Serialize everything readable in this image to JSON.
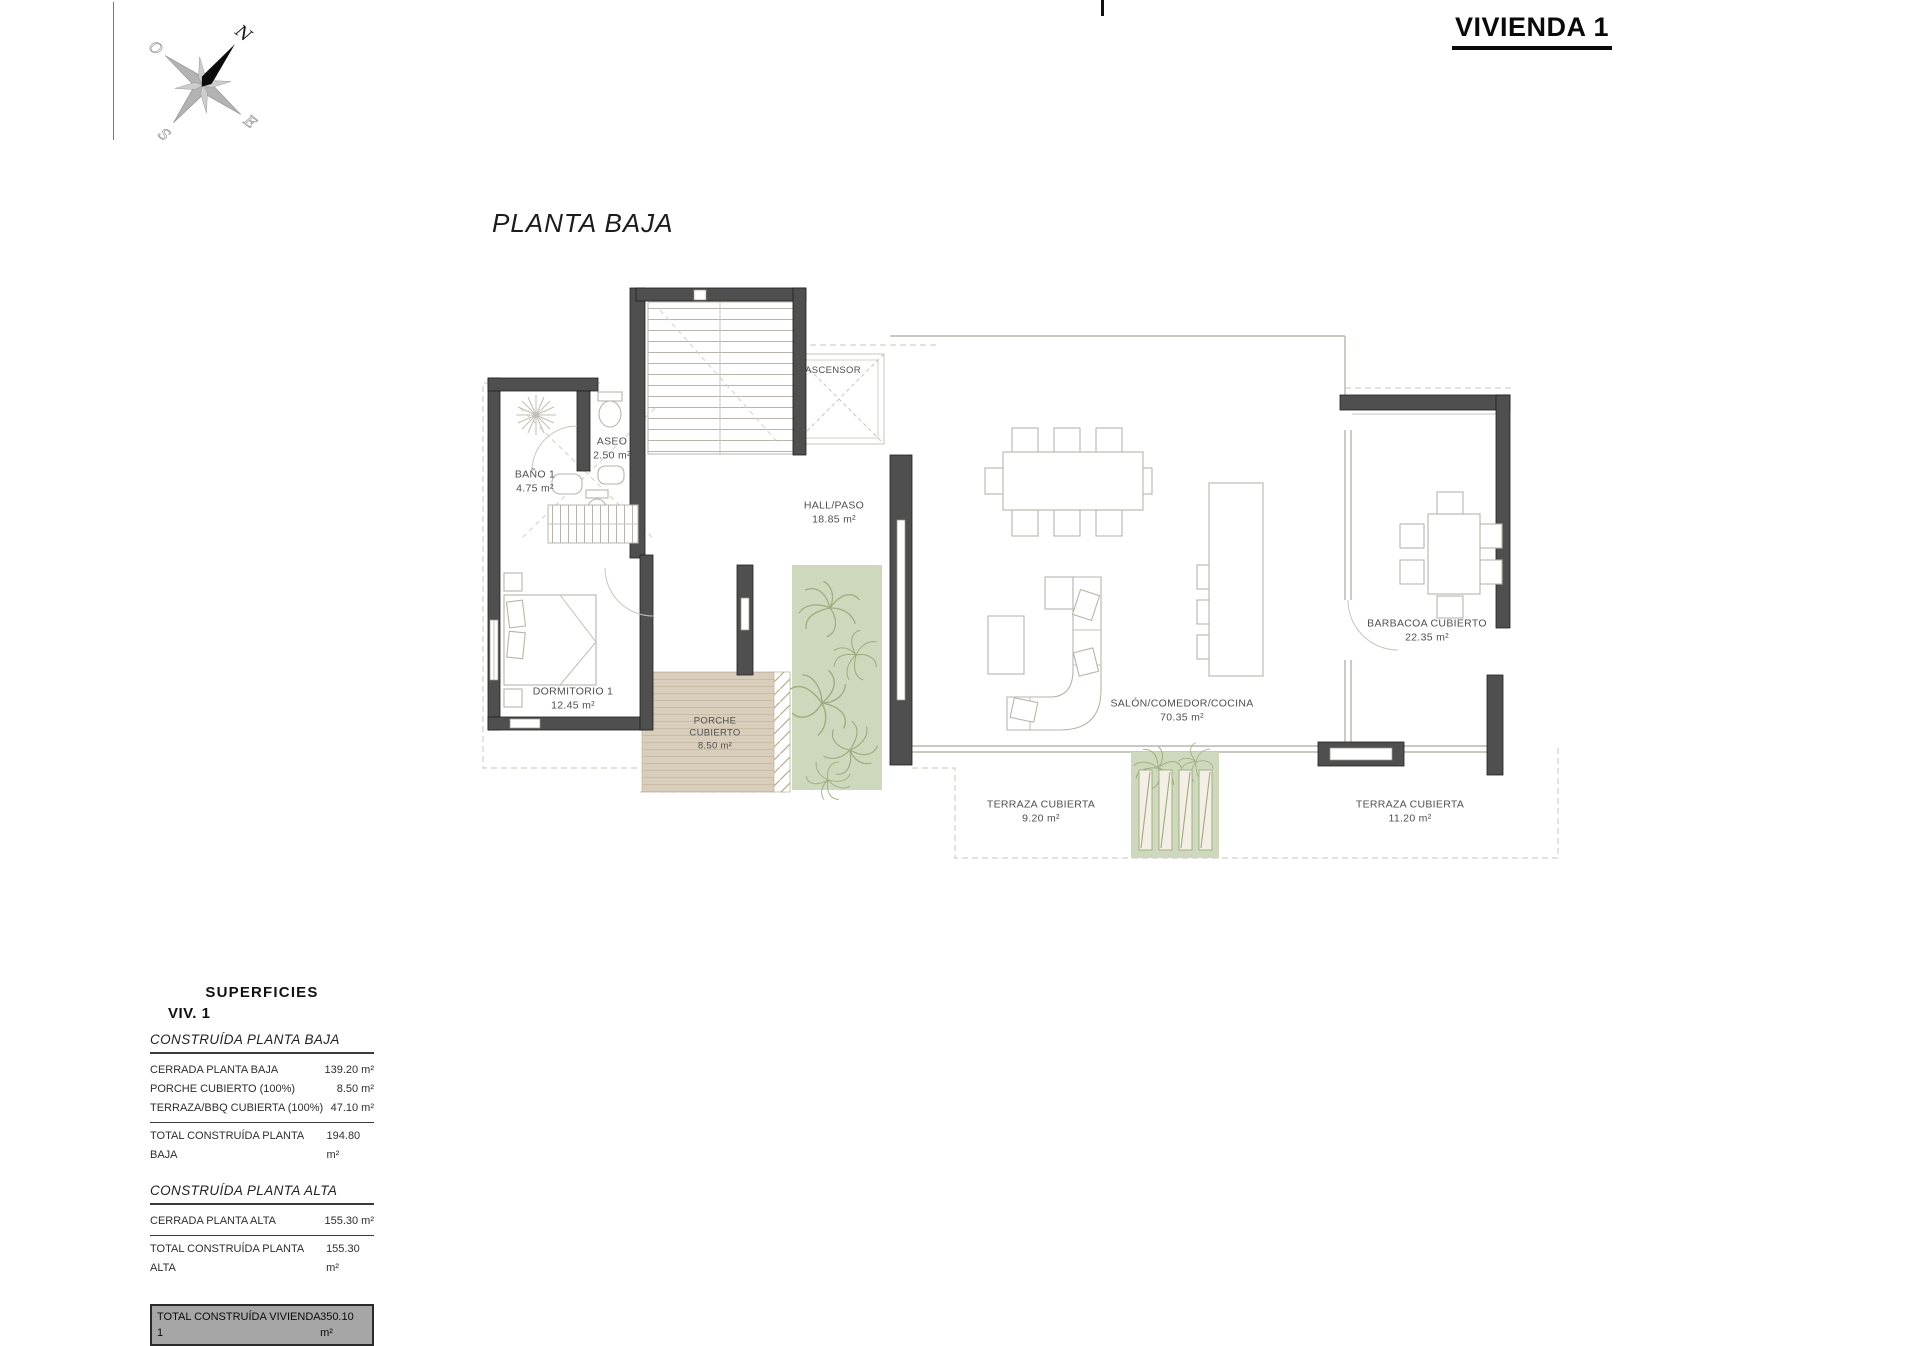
{
  "header": {
    "title": "VIVIENDA 1"
  },
  "plan": {
    "title": "PLANTA BAJA"
  },
  "compass": {
    "n": "N",
    "e": "E",
    "s": "S",
    "o": "O"
  },
  "rooms": [
    {
      "id": "aseo",
      "name": "ASEO",
      "area": "2.50 m²"
    },
    {
      "id": "bano1",
      "name": "BAÑO 1",
      "area": "4.75 m²"
    },
    {
      "id": "dormitorio1",
      "name": "DORMITORIO 1",
      "area": "12.45 m²"
    },
    {
      "id": "ascensor",
      "name": "ASCENSOR",
      "area": ""
    },
    {
      "id": "hall",
      "name": "HALL/PASO",
      "area": "18.85 m²"
    },
    {
      "id": "porche",
      "name": "PORCHE CUBIERTO",
      "area": "8.50 m²"
    },
    {
      "id": "salon",
      "name": "SALÓN/COMEDOR/COCINA",
      "area": "70.35 m²"
    },
    {
      "id": "barbacoa",
      "name": "BARBACOA CUBIERTO",
      "area": "22.35 m²"
    },
    {
      "id": "terraza1",
      "name": "TERRAZA CUBIERTA",
      "area": "9.20 m²"
    },
    {
      "id": "terraza2",
      "name": "TERRAZA CUBIERTA",
      "area": "11.20 m²"
    }
  ],
  "summary": {
    "title": "SUPERFICIES",
    "subtitle": "VIV. 1",
    "sections": [
      {
        "heading": "CONSTRUÍDA PLANTA BAJA",
        "rows": [
          {
            "label": "CERRADA PLANTA BAJA",
            "value": "139.20 m²"
          },
          {
            "label": "PORCHE CUBIERTO (100%)",
            "value": "8.50 m²"
          },
          {
            "label": "TERRAZA/BBQ CUBIERTA (100%)",
            "value": "47.10 m²"
          }
        ],
        "total": {
          "label": "TOTAL CONSTRUÍDA PLANTA BAJA",
          "value": "194.80 m²"
        }
      },
      {
        "heading": "CONSTRUÍDA PLANTA ALTA",
        "rows": [
          {
            "label": "CERRADA PLANTA ALTA",
            "value": "155.30 m²"
          }
        ],
        "total": {
          "label": "TOTAL CONSTRUÍDA PLANTA ALTA",
          "value": "155.30 m²"
        }
      }
    ],
    "grand_total": {
      "label": "TOTAL CONSTRUÍDA VIVIENDA 1",
      "value": "350.10 m²"
    }
  },
  "colors": {
    "wall": "#4f4f4f",
    "deck": "#d9cebc",
    "garden": "#ced8bc",
    "total_row_bg": "#a6a6a6"
  }
}
